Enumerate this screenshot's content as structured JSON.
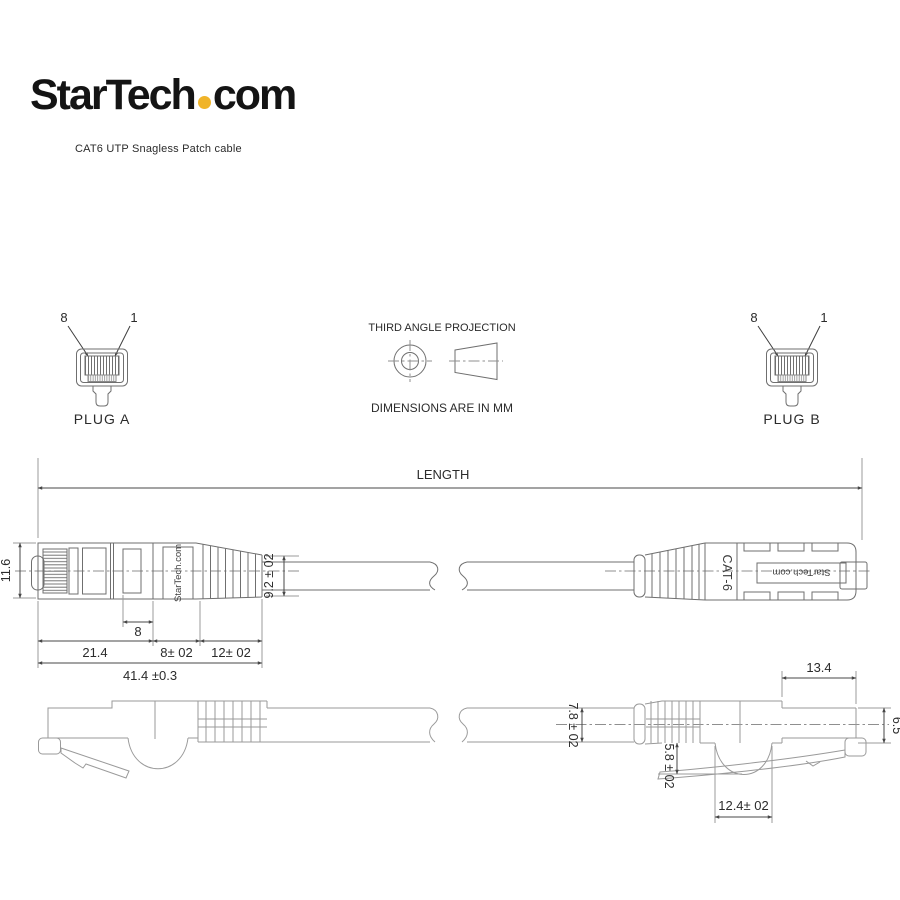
{
  "brand": {
    "name_main": "StarTech",
    "name_suffix": "com",
    "dot_color": "#F0B429",
    "tagline": "CAT6 UTP Snagless Patch cable"
  },
  "projection": {
    "title": "THIRD ANGLE PROJECTION",
    "units": "DIMENSIONS ARE IN MM"
  },
  "plug_a": {
    "label": "PLUG A",
    "pin_left": "8",
    "pin_right": "1"
  },
  "plug_b": {
    "label": "PLUG B",
    "pin_left": "8",
    "pin_right": "1"
  },
  "length_dim": {
    "label": "LENGTH"
  },
  "top_view": {
    "brand_label": "StarTech.com",
    "brand_label_mirrored": "StarTech.com",
    "cat_label": "CAT-6",
    "dims": {
      "plug_height": "11.6",
      "window": "8",
      "plug_body": "21.4",
      "mid_section": "8± 02",
      "boot_section": "12± 02",
      "overall": "41.4 ±0.3",
      "boot_tail_height": "9.2 ± 02"
    }
  },
  "side_view": {
    "dims": {
      "cable_od": "7.8 ± 02",
      "boot_lip": "5.8 ± 02",
      "boot_scallop": "12.4± 02",
      "plug_front": "13.4",
      "front_height": "6.5"
    }
  },
  "colors": {
    "background": "#ffffff",
    "line_main": "#6f6f6f",
    "line_light": "#9a9a9a",
    "dimension": "#474747",
    "text": "#2b2b2b",
    "logo_dot": "#F0B429"
  }
}
